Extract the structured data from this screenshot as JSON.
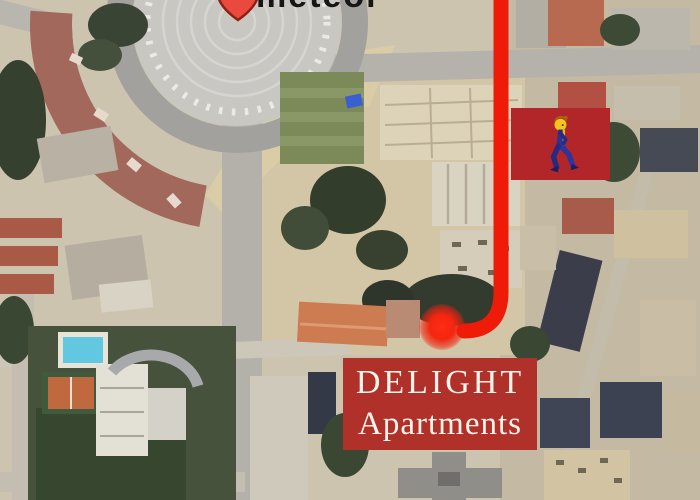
{
  "map": {
    "type": "satellite-aerial-photo",
    "notable_features": [
      "roundabout-with-ring-parking",
      "curved-terracotta-building",
      "construction-site",
      "warehouses",
      "hotel-grounds",
      "swimming-pool",
      "tennis-court",
      "dense-urban-blocks"
    ],
    "palette": {
      "base_tan": "#cdc4b0",
      "road_gray": "#b4b1ab",
      "roundabout_gray": "#c9c7c2",
      "curved_building_roof": "#a3685c",
      "grass_green": "#7c8a5a",
      "tree_dark_green": "#38402f",
      "pool_blue": "#62c8e2",
      "tennis_orange": "#c0693f",
      "dirt_sand": "#d9cca6"
    }
  },
  "overlays": {
    "origin_text": {
      "partial_text": "meteor",
      "color": "#161616"
    },
    "origin_pin": {
      "icon": "map-pin-icon",
      "fill": "#ea4a3d",
      "outline": "#8e1f15"
    },
    "route": {
      "color": "#ee1b09",
      "width_px": 15,
      "shape": "vertical line from top edge hooking left at bottom"
    },
    "destination_dot": {
      "color": "#ff2d13"
    },
    "pedestrian_badge": {
      "icon": "walking-person-icon",
      "bg_color": "#b2262a",
      "person_colors": {
        "head": "#f6c51c",
        "hair": "#a8650f",
        "body": "#2d3190",
        "stripe": "#f0b31a"
      }
    },
    "destination_label": {
      "line1": "DELIGHT",
      "line2": "Apartments",
      "bg_color": "#b0302a",
      "text_color": "#fdf5ec"
    }
  }
}
